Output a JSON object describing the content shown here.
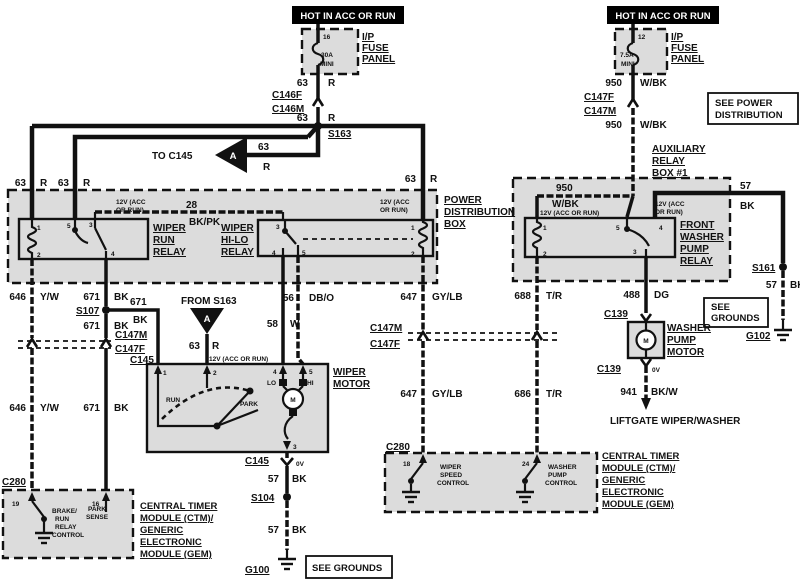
{
  "banners": {
    "left": "HOT IN ACC OR RUN",
    "right": "HOT IN ACC OR RUN"
  },
  "fuses": {
    "panel": [
      "I/P",
      "FUSE",
      "PANEL"
    ],
    "left": {
      "pin": "16",
      "rating": "30A",
      "size": "MINI"
    },
    "right": {
      "pin": "12",
      "rating": "7.5A",
      "size": "MINI"
    }
  },
  "notes": {
    "see_power": [
      "SEE POWER",
      "DISTRIBUTION"
    ],
    "see_grounds_right": [
      "SEE",
      "GROUNDS"
    ],
    "see_grounds_bottom": "SEE GROUNDS",
    "to_c145": "TO C145",
    "from_s163": "FROM S163",
    "arrow_a": "A",
    "liftgate": "LIFTGATE WIPER/WASHER"
  },
  "connectors": {
    "c146f": "C146F",
    "c146m": "C146M",
    "c147f": "C147F",
    "c147m": "C147M",
    "c145": "C145",
    "c139": "C139",
    "c280": "C280",
    "zero_v": "0V"
  },
  "splices": {
    "s163": "S163",
    "s107": "S107",
    "s104": "S104",
    "s161": "S161"
  },
  "grounds": {
    "g100": "G100",
    "g102": "G102"
  },
  "boxes": {
    "power_dist": [
      "POWER",
      "DISTRIBUTION",
      "BOX"
    ],
    "aux_relay": [
      "AUXILIARY",
      "RELAY",
      "BOX #1"
    ],
    "wiper_run_relay": [
      "WIPER",
      "RUN",
      "RELAY"
    ],
    "wiper_hilo_relay": [
      "WIPER",
      "HI-LO",
      "RELAY"
    ],
    "front_washer_relay": [
      "FRONT",
      "WASHER",
      "PUMP",
      "RELAY"
    ],
    "wiper_motor": [
      "WIPER",
      "MOTOR"
    ],
    "washer_pump_motor": [
      "WASHER",
      "PUMP",
      "MOTOR"
    ],
    "ctm": [
      "CENTRAL TIMER",
      "MODULE (CTM)/",
      "GENERIC",
      "ELECTRONIC",
      "MODULE (GEM)"
    ]
  },
  "wires": {
    "w63": {
      "num": "63",
      "color": "R"
    },
    "w28": {
      "num": "28",
      "color": "BK/PK"
    },
    "w646": {
      "num": "646",
      "color": "Y/W"
    },
    "w671": {
      "num": "671",
      "color": "BK"
    },
    "w58": {
      "num": "58",
      "color": "W"
    },
    "w56": {
      "num": "56",
      "color": "DB/O"
    },
    "w647": {
      "num": "647",
      "color": "GY/LB"
    },
    "w688": {
      "num": "688",
      "color": "T/R"
    },
    "w686": {
      "num": "686",
      "color": "T/R"
    },
    "w488": {
      "num": "488",
      "color": "DG"
    },
    "w941": {
      "num": "941",
      "color": "BK/W"
    },
    "w950": {
      "num": "950",
      "color": "W/BK"
    },
    "w57": {
      "num": "57",
      "color": "BK"
    }
  },
  "pins": {
    "p1": "1",
    "p2": "2",
    "p3": "3",
    "p4": "4",
    "p5": "5",
    "p12": "12",
    "p16": "16",
    "p18": "18",
    "p19": "19",
    "p24": "24"
  },
  "internal": {
    "v12_l1": "12V (ACC",
    "v12_l2": "OR RUN)",
    "v12_single": "12V (ACC OR RUN)",
    "run": "RUN",
    "park": "PARK",
    "lo": "LO",
    "hi": "HI",
    "motor_m": "M",
    "brc": [
      "BRAKE/",
      "RUN",
      "RELAY",
      "CONTROL"
    ],
    "park_sense": [
      "PARK",
      "SENSE"
    ],
    "wiper_speed": [
      "WIPER",
      "SPEED",
      "CONTROL"
    ],
    "washer_pump": [
      "WASHER",
      "PUMP",
      "CONTROL"
    ]
  },
  "colors": {
    "ink": "#111111",
    "shade": "#dcdcdc",
    "banner_bg": "#000000",
    "paper": "#ffffff"
  }
}
